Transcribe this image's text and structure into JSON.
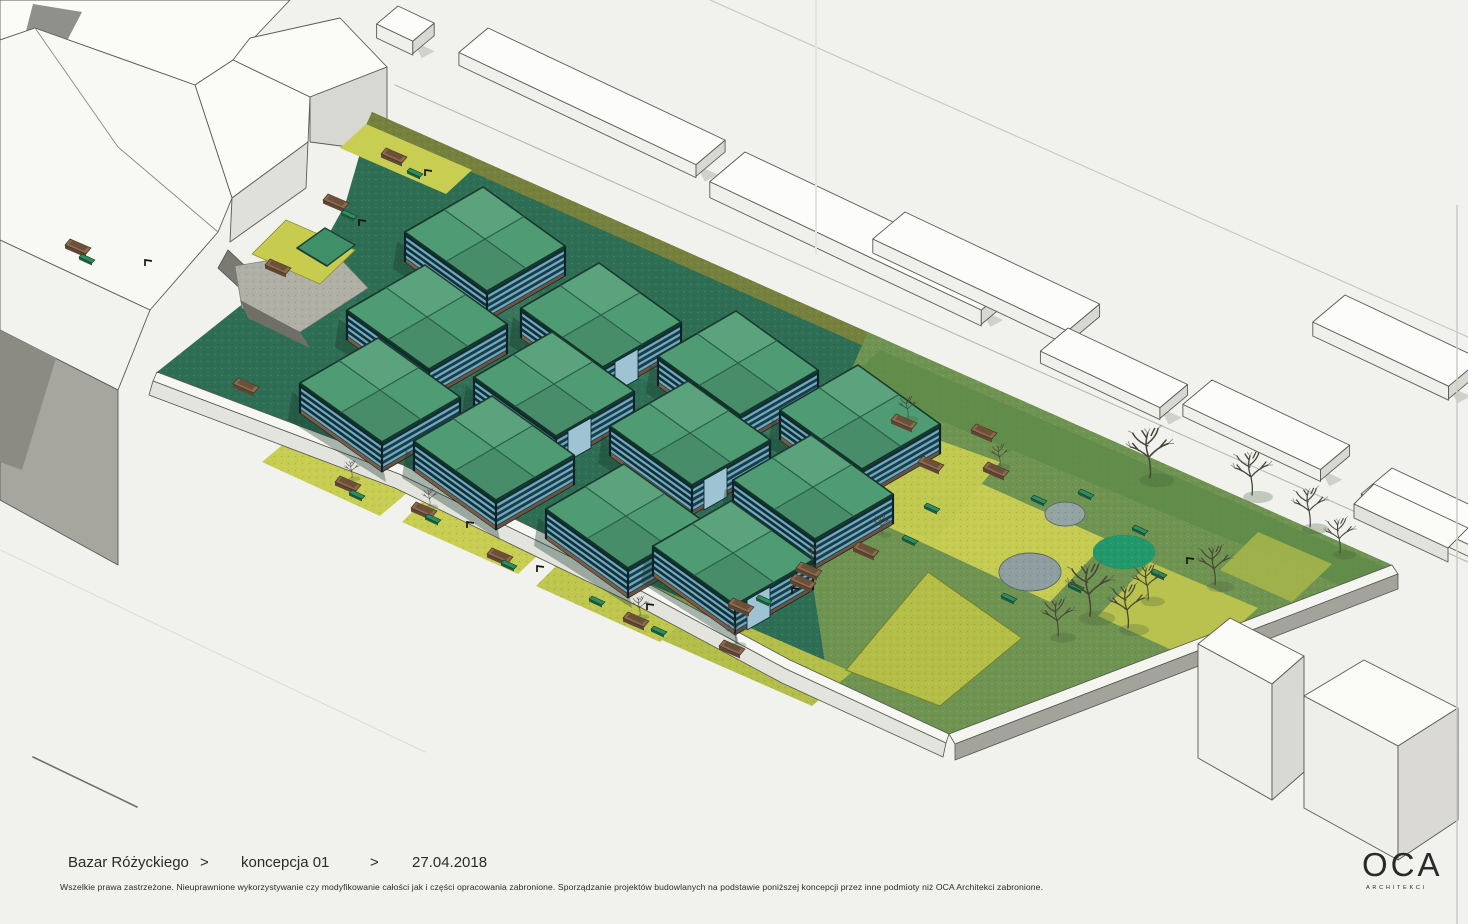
{
  "title_block": {
    "project": "Bazar Różyckiego",
    "separator_1": ">",
    "concept": "koncepcja 01",
    "separator_2": ">",
    "date": "27.04.2018",
    "disclaimer": "Wszelkie prawa zastrzeżone. Nieuprawnione wykorzystywanie czy modyfikowanie całości jak i części opracowania zabronione. Sporządzanie projektów budowlanych na podstawie poniższej koncepcji przez inne podmioty niż OCA Architekci zabronione."
  },
  "logo": {
    "acronym": "OCA",
    "subtitle": "ARCHITEKCI"
  },
  "scene": {
    "type": "axonometric-site-plan",
    "subject": "market square concept with pavilion grid and park",
    "pavilion_count": 12,
    "colors": {
      "paper": "#f1f1ee",
      "site_paving": "#2e6e55",
      "hedge": "#75813c",
      "grass_bright": "#c8ce52",
      "grass_olive": "#aab84c",
      "park_green": "#6f9452",
      "park_green_dark": "#5d8947",
      "parterre": "#b5bf48",
      "roof_green": "#4f9c74",
      "louver_blue": "#6fa9bf",
      "wall_dark": "#132f38",
      "wood": "#7a5c44",
      "circle_gray": "#94a3a3",
      "circle_teal": "#21996c",
      "building_white": "#fbfbf8",
      "building_gray": "#a3a39c",
      "tree": "#474538"
    },
    "pavilions": [
      {
        "x": 485,
        "y": 239
      },
      {
        "x": 427,
        "y": 317
      },
      {
        "x": 601,
        "y": 315,
        "door": true
      },
      {
        "x": 380,
        "y": 390
      },
      {
        "x": 554,
        "y": 384,
        "door": true
      },
      {
        "x": 738,
        "y": 363
      },
      {
        "x": 494,
        "y": 448
      },
      {
        "x": 690,
        "y": 433,
        "door": true
      },
      {
        "x": 860,
        "y": 417
      },
      {
        "x": 626,
        "y": 516
      },
      {
        "x": 813,
        "y": 487
      },
      {
        "x": 733,
        "y": 553,
        "door": true
      }
    ],
    "bars": [
      {
        "x": 488,
        "y": 28,
        "len": 262,
        "w": 38,
        "h": 13
      },
      {
        "x": 745,
        "y": 152,
        "len": 300,
        "w": 46,
        "h": 16
      },
      {
        "x": 905,
        "y": 212,
        "len": 215,
        "w": 42,
        "h": 14
      },
      {
        "x": 1068,
        "y": 328,
        "len": 132,
        "w": 36,
        "h": 12
      },
      {
        "x": 1212,
        "y": 380,
        "len": 152,
        "w": 38,
        "h": 12
      },
      {
        "x": 1345,
        "y": 295,
        "len": 150,
        "w": 42,
        "h": 14
      },
      {
        "x": 1392,
        "y": 468,
        "len": 130,
        "w": 40,
        "h": 12
      },
      {
        "x": 398,
        "y": 6,
        "len": 40,
        "w": 28,
        "h": 14
      }
    ],
    "trees": [
      {
        "x": 1150,
        "y": 478,
        "s": 1.15
      },
      {
        "x": 1252,
        "y": 495,
        "s": 1.0
      },
      {
        "x": 1310,
        "y": 527,
        "s": 0.9
      },
      {
        "x": 1340,
        "y": 553,
        "s": 0.8
      },
      {
        "x": 1215,
        "y": 585,
        "s": 0.9
      },
      {
        "x": 1090,
        "y": 616,
        "s": 1.2
      },
      {
        "x": 1128,
        "y": 628,
        "s": 1.0
      },
      {
        "x": 1058,
        "y": 636,
        "s": 0.85
      },
      {
        "x": 1148,
        "y": 600,
        "s": 0.8
      },
      {
        "x": 908,
        "y": 418,
        "s": 0.5
      },
      {
        "x": 1000,
        "y": 466,
        "s": 0.5
      },
      {
        "x": 882,
        "y": 534,
        "s": 0.45
      },
      {
        "x": 813,
        "y": 566,
        "s": 0.45
      },
      {
        "x": 736,
        "y": 644,
        "s": 0.5
      },
      {
        "x": 640,
        "y": 616,
        "s": 0.45
      },
      {
        "x": 430,
        "y": 506,
        "s": 0.4
      },
      {
        "x": 352,
        "y": 478,
        "s": 0.4
      }
    ],
    "benches": [
      {
        "x": 418,
        "y": 170
      },
      {
        "x": 352,
        "y": 212
      },
      {
        "x": 90,
        "y": 256
      },
      {
        "x": 360,
        "y": 492
      },
      {
        "x": 436,
        "y": 516
      },
      {
        "x": 512,
        "y": 562
      },
      {
        "x": 600,
        "y": 598
      },
      {
        "x": 662,
        "y": 628
      },
      {
        "x": 767,
        "y": 597
      },
      {
        "x": 913,
        "y": 537
      },
      {
        "x": 935,
        "y": 505
      },
      {
        "x": 1042,
        "y": 497
      },
      {
        "x": 1089,
        "y": 491
      },
      {
        "x": 1012,
        "y": 595
      },
      {
        "x": 1079,
        "y": 584
      },
      {
        "x": 1143,
        "y": 527
      },
      {
        "x": 1162,
        "y": 571
      }
    ],
    "planters": [
      {
        "x": 398,
        "y": 152
      },
      {
        "x": 340,
        "y": 198
      },
      {
        "x": 282,
        "y": 263
      },
      {
        "x": 82,
        "y": 243
      },
      {
        "x": 250,
        "y": 382
      },
      {
        "x": 352,
        "y": 480
      },
      {
        "x": 428,
        "y": 506
      },
      {
        "x": 504,
        "y": 552
      },
      {
        "x": 640,
        "y": 616
      },
      {
        "x": 736,
        "y": 644
      },
      {
        "x": 807,
        "y": 578
      },
      {
        "x": 745,
        "y": 602
      },
      {
        "x": 870,
        "y": 546
      },
      {
        "x": 908,
        "y": 418
      },
      {
        "x": 1000,
        "y": 466
      },
      {
        "x": 988,
        "y": 428
      },
      {
        "x": 935,
        "y": 460
      },
      {
        "x": 813,
        "y": 566
      }
    ],
    "hooks": [
      {
        "x": 470,
        "y": 524
      },
      {
        "x": 795,
        "y": 590
      },
      {
        "x": 428,
        "y": 172
      },
      {
        "x": 362,
        "y": 222
      },
      {
        "x": 650,
        "y": 606
      },
      {
        "x": 1190,
        "y": 560
      },
      {
        "x": 148,
        "y": 262
      },
      {
        "x": 540,
        "y": 568
      }
    ]
  }
}
